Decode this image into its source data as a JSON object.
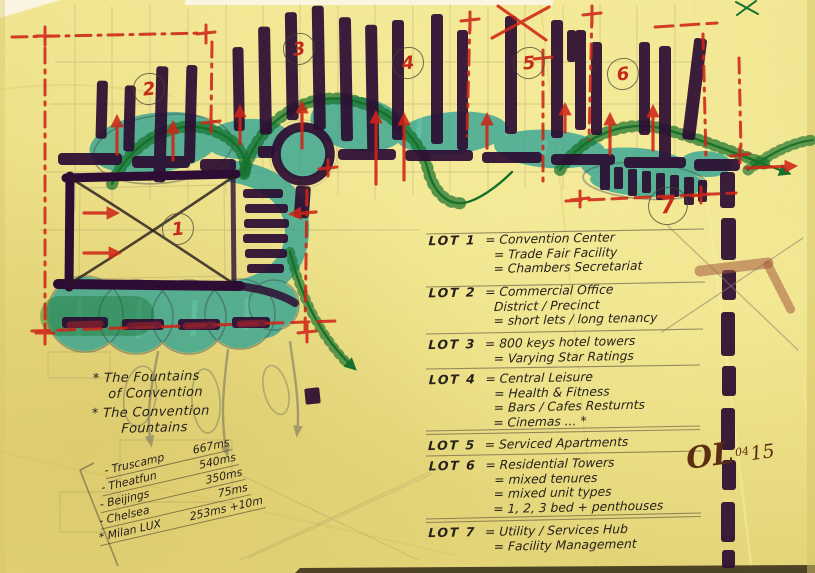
{
  "lot_markers": [
    "1",
    "2",
    "3",
    "4",
    "5",
    "6",
    "7"
  ],
  "legend": {
    "entries": [
      {
        "label": "LOT 1",
        "items": [
          "= Convention Center",
          "= Trade Fair Facility",
          "= Chambers Secretariat"
        ]
      },
      {
        "label": "LOT 2",
        "items": [
          "= Commercial Office",
          "District / Precinct",
          "= short lets / long tenancy"
        ]
      },
      {
        "label": "LOT 3",
        "items": [
          "= 800 keys hotel towers",
          "= Varying Star Ratings"
        ]
      },
      {
        "label": "LOT 4",
        "items": [
          "= Central Leisure",
          "= Health & Fitness",
          "= Bars / Cafes Resturnts",
          "= Cinemas ... *"
        ]
      },
      {
        "label": "LOT 5",
        "items": [
          "= Serviced Apartments"
        ]
      },
      {
        "label": "LOT 6",
        "items": [
          "= Residential Towers",
          "= mixed tenures",
          "= mixed unit types",
          "= 1, 2, 3 bed + penthouses"
        ]
      },
      {
        "label": "LOT 7",
        "items": [
          "= Utility / Services Hub",
          "= Facility Management"
        ]
      }
    ]
  },
  "notes": {
    "fountains": [
      "* The Fountains",
      "of Convention",
      "* The Convention",
      "Fountains"
    ]
  },
  "metrics": {
    "items": [
      {
        "name": "- Truscamp",
        "value": "667ms"
      },
      {
        "name": "- Theatfun",
        "value": "540ms"
      },
      {
        "name": "- Beijings",
        "value": "350ms"
      },
      {
        "name": "- Chelsea",
        "value": "75ms"
      },
      {
        "name": "* Milan LUX",
        "value": "253ms +10m"
      }
    ]
  },
  "signature": {
    "initials": "OL",
    "month": "04",
    "year": "15"
  },
  "colors": {
    "paper": "#eadd83",
    "marker_purple": "#2d0d33",
    "highlighter_teal": "#2fa697",
    "pen_red": "#cf2517",
    "pen_green": "#15702b",
    "ink": "#26211a",
    "pencil": "#85795c"
  }
}
